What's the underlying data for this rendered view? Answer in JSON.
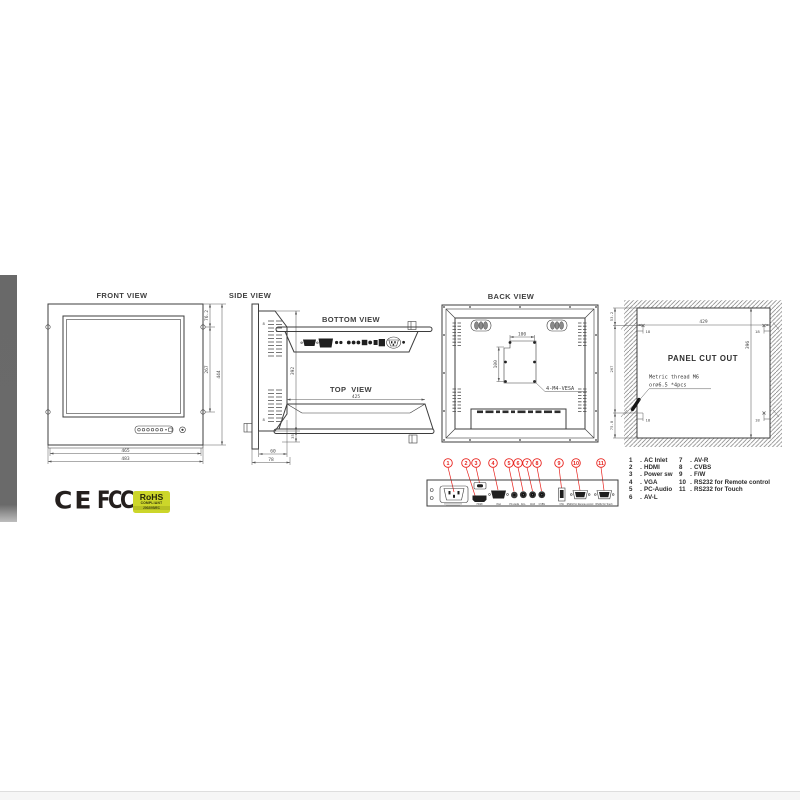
{
  "views": {
    "front": {
      "title": "FRONT VIEW",
      "dims": {
        "width_outer": "483",
        "width_inner": "465",
        "height": "444",
        "hole_top": "76.2",
        "hole_span": "267"
      }
    },
    "side": {
      "title": "SIDE VIEW",
      "dims": {
        "height": "392",
        "depth_body": "60",
        "depth_total": "78",
        "bracket": "35"
      },
      "vent_mark": "8"
    },
    "bottom": {
      "title": "BOTTOM VIEW"
    },
    "top": {
      "title": "TOP  VIEW",
      "dims": {
        "width": "425"
      }
    },
    "back": {
      "title": "BACK VIEW",
      "vesa": {
        "h": "100",
        "v": "100",
        "label": "4-M4-VESA"
      }
    },
    "cutout": {
      "title": "PANEL CUT OUT",
      "note_line1": "Metric thread M6",
      "note_line2": "or∅6.5 *4pcs",
      "dims": {
        "width": "429",
        "height": "396",
        "seg_top": "53.2",
        "seg_mid": "267",
        "seg_bottom": "75.8",
        "inset": "18"
      }
    }
  },
  "callouts": [
    "1",
    "2",
    "3",
    "4",
    "5",
    "6",
    "7",
    "8",
    "9",
    "10",
    "11"
  ],
  "ports": [
    "HDMI",
    "VGA",
    "PC-Audio",
    "AV-L",
    "AV-R",
    "CVBS",
    "F/W",
    "RS232 for Remote control",
    "RS232 for Touch"
  ],
  "legend": {
    "sep": ".",
    "col1": [
      {
        "num": "1",
        "label": "AC Inlet"
      },
      {
        "num": "2",
        "label": "HDMI"
      },
      {
        "num": "3",
        "label": "Power sw"
      },
      {
        "num": "4",
        "label": "VGA"
      },
      {
        "num": "5",
        "label": "PC-Audio"
      },
      {
        "num": "6",
        "label": "AV-L"
      }
    ],
    "col2": [
      {
        "num": "7",
        "label": "AV-R"
      },
      {
        "num": "8",
        "label": "CVBS"
      },
      {
        "num": "9",
        "label": "F/W"
      },
      {
        "num": "10",
        "label": "RS232 for Remote control"
      },
      {
        "num": "11",
        "label": "RS232 for Touch"
      }
    ]
  },
  "logos": {
    "ce": "CE",
    "fcc": "FCC",
    "rohs": {
      "line1": "RoHS",
      "line2": "COMPLIANT",
      "line3": "2002/95/EC"
    }
  },
  "colors": {
    "accent_red": "#e8221d",
    "rohs_green": "#ccd62a",
    "line": "#3d3d3d",
    "sidebar_gray": "#6a6a6a"
  }
}
